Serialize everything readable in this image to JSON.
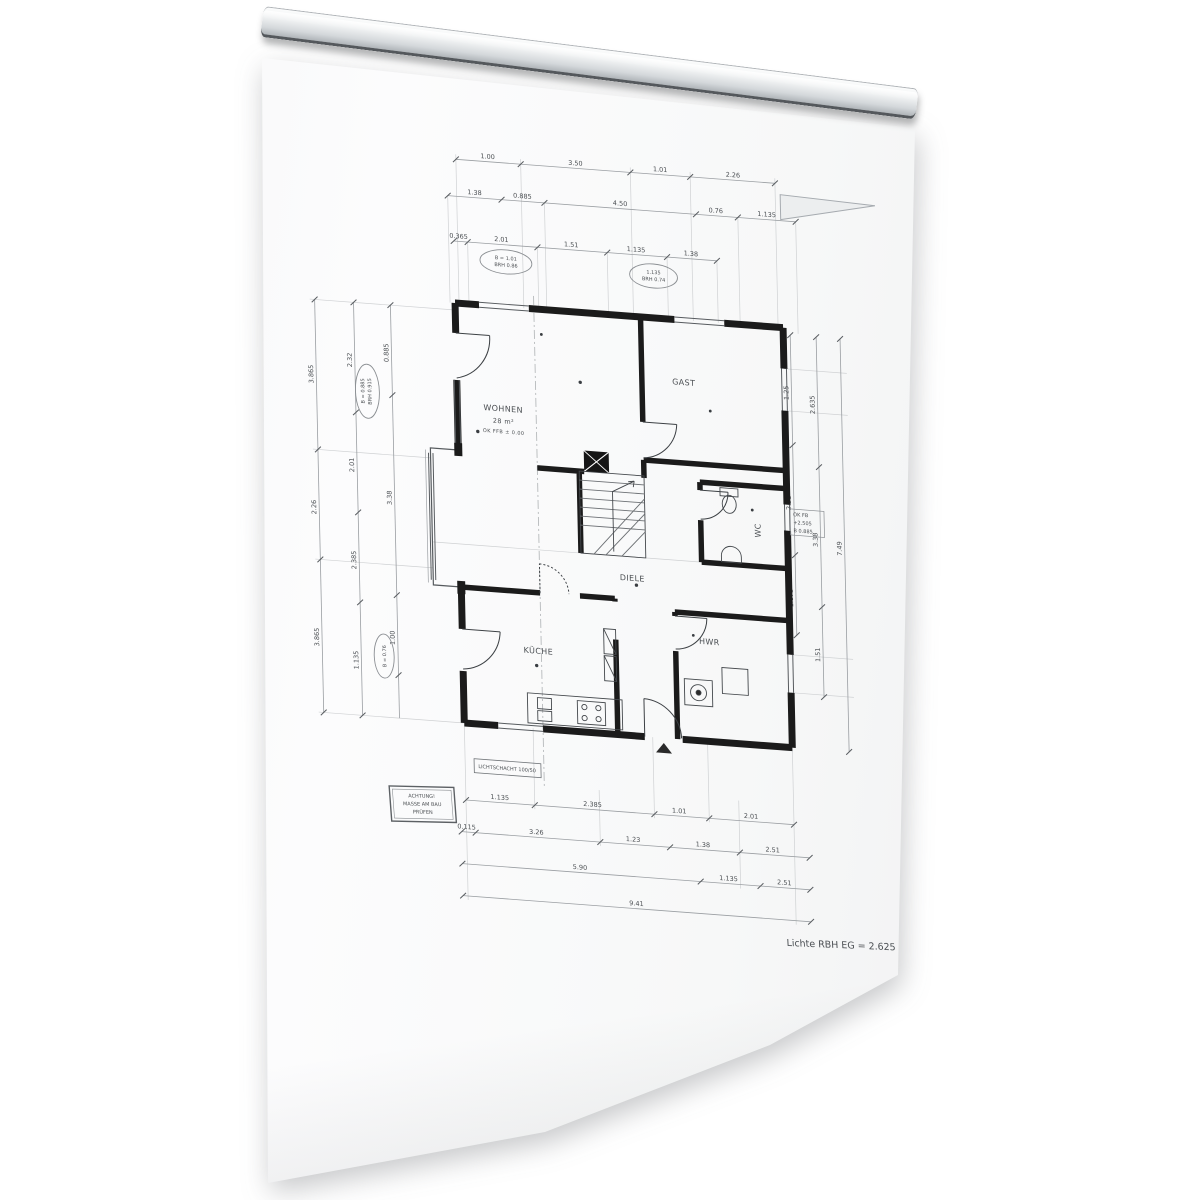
{
  "plan": {
    "rooms": {
      "wohnen": {
        "name": "WOHNEN",
        "area": "28 m²",
        "level": "OK FFB ± 0.00"
      },
      "gast": {
        "name": "GAST"
      },
      "kueche": {
        "name": "KÜCHE"
      },
      "diele": {
        "name": "DIELE"
      },
      "hwr": {
        "name": "HWR"
      },
      "wc": {
        "name": "WC"
      }
    },
    "note": "Lichte RBH EG = 2.625",
    "stamp": {
      "line1": "ACHTUNG!",
      "line2": "MASSE AM BAU",
      "line3": "PRÜFEN"
    },
    "shaft_label": "LICHTSCHACHT 100/50",
    "ovals": {
      "top1a": "B = 1.01",
      "top1b": "BRH 0.86",
      "top2a": "1.135",
      "top2b": "BRH 0.74",
      "left1a": "B = 0.885",
      "left1b": "BRH 0.915",
      "left2": "B = 0.76"
    },
    "annotations": {
      "right1": "OK FB",
      "right2": "+2.505",
      "right3": "B 0.885"
    },
    "dims": {
      "top1": [
        "1.00",
        "3.50",
        "1.01",
        "2.26"
      ],
      "top2": [
        "1.38",
        "0.885",
        "4.50",
        "0.76",
        "1.135"
      ],
      "top3": [
        "0.365",
        "2.01",
        "1.51",
        "1.135",
        "1.38"
      ],
      "bottom1": [
        "1.135",
        "2.385",
        "1.01",
        "2.01"
      ],
      "bottom2": [
        "0.115",
        "3.26",
        "1.23",
        "1.38",
        "2.51"
      ],
      "bottom3": [
        "5.90",
        "1.135",
        "2.51"
      ],
      "bottom_total": "9.41",
      "left1": [
        "3.865",
        "2.26",
        "3.865"
      ],
      "left2": [
        "2.32",
        "2.01",
        "2.385",
        "1.135"
      ],
      "left3": [
        "0.885",
        "3.38",
        "1.00"
      ],
      "right1": [
        "1.25",
        "2.51",
        "1.875"
      ],
      "right2": [
        "2.635",
        "3.38",
        "1.51"
      ],
      "right3": [
        "7.49"
      ]
    }
  }
}
